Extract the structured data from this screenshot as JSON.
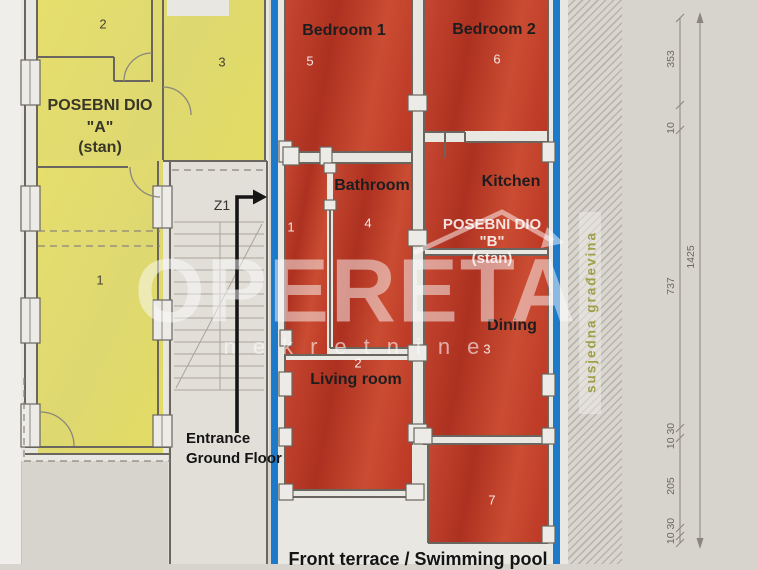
{
  "unit_a": {
    "title_1": "POSEBNI DIO",
    "title_2": "\"A\"",
    "title_3": "(stan)",
    "room_numbers": {
      "top": "2",
      "right": "3",
      "main": "1"
    }
  },
  "unit_b": {
    "title_1": "POSEBNI DIO",
    "title_2": "\"B\"",
    "title_3": "(stan)",
    "rooms": {
      "bedroom1": {
        "label": "Bedroom 1",
        "number": "5"
      },
      "bedroom2": {
        "label": "Bedroom 2",
        "number": "6"
      },
      "bathroom": {
        "label": "Bathroom",
        "number": "4"
      },
      "kitchen": {
        "label": "Kitchen"
      },
      "dining": {
        "label": "Dining",
        "number": "3"
      },
      "living": {
        "label": "Living room",
        "number": "2"
      },
      "hall": {
        "number": "1"
      },
      "terrace_room": {
        "number": "7"
      }
    }
  },
  "labels": {
    "stair_mark": "Z1",
    "entrance_1": "Entrance",
    "entrance_2": "Ground Floor",
    "bottom": "Front terrace / Swimming pool",
    "neighbor": "susjedna građevina"
  },
  "dimensions": {
    "seg_1": "353",
    "seg_2": "10",
    "seg_3": "737",
    "seg_4": "10 30",
    "seg_5": "205",
    "seg_6": "10 30",
    "total": "1425"
  },
  "watermark": {
    "brand": "OPERETA",
    "sub": "nekretnine"
  },
  "colors": {
    "unit_a_fill": "#e4dd68",
    "unit_b_fill": "#c13a27",
    "boundary_blue": "#1d79c9",
    "neighbor_text": "#a0a04a"
  }
}
